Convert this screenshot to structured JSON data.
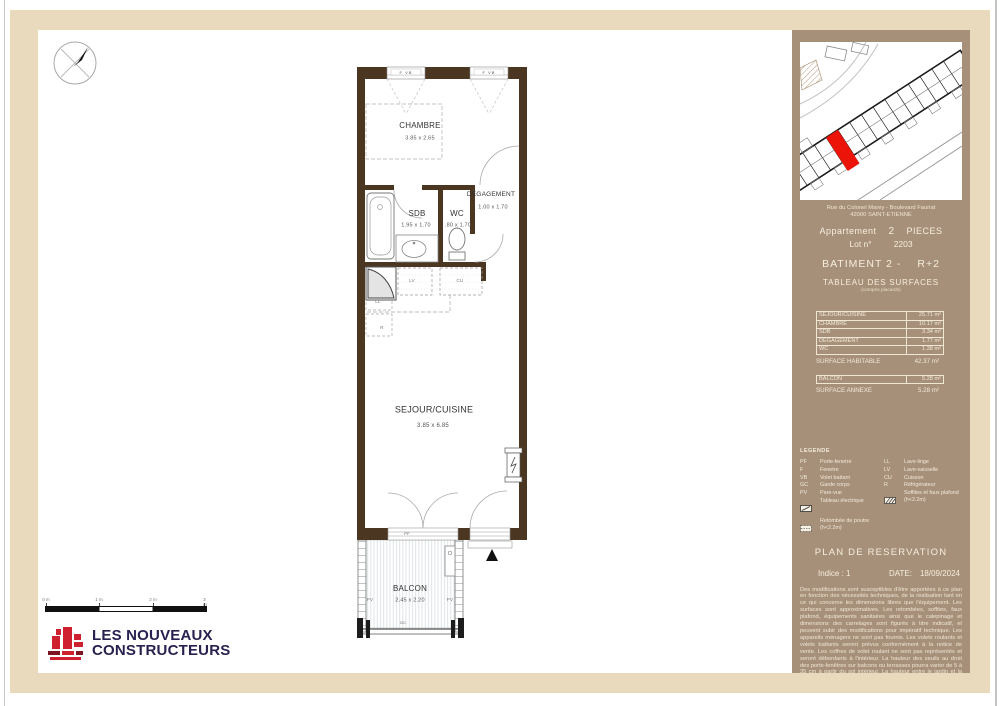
{
  "plan": {
    "rooms": {
      "chambre": {
        "name": "CHAMBRE",
        "dims": "3.85 x 2.65"
      },
      "degagement": {
        "name": "DEGAGEMENT",
        "dims": "1.00 x 1.70"
      },
      "sdb": {
        "name": "SDB",
        "dims": "1.95 x 1.70"
      },
      "wc": {
        "name": "WC",
        "dims": ".80 x 1.70"
      },
      "sejour": {
        "name": "SEJOUR/CUISINE",
        "dims": "3.85 x 6.85"
      },
      "balcon": {
        "name": "BALCON",
        "dims": "2.45 x 2.20"
      }
    },
    "tags": {
      "f_vb": "F  VB",
      "pf": "PF",
      "pv": "PV",
      "gc": "GC",
      "lv": "LV",
      "cu": "CU",
      "ll": "LL",
      "r": "R"
    },
    "colors": {
      "wall": "#4a3621",
      "highlight_unit": "#ec1309"
    }
  },
  "scale_bar": {
    "labels": [
      "0 m",
      "1 m",
      "2 m",
      "3 m"
    ]
  },
  "logo": {
    "line1": "LES NOUVEAUX",
    "line2": "CONSTRUCTEURS",
    "accent": "#cf2030",
    "text_color": "#2a2150"
  },
  "sidebar": {
    "address_line1": "Rue du Colonel Marey - Boulevard Fauriat",
    "address_line2": "42000 SAINT-ETIENNE",
    "apartment": {
      "label": "Appartement",
      "rooms_count": "2",
      "rooms_label": "PIECES"
    },
    "lot": {
      "label": "Lot n°",
      "number": "2203"
    },
    "building": "BATIMENT 2 -",
    "floor": "R+2",
    "surfaces_title": "TABLEAU DES SURFACES",
    "surfaces_subtitle": "(compris placards)",
    "table": {
      "rows": [
        {
          "label": "SEJOUR/CUISINE",
          "value": "25.71 m²"
        },
        {
          "label": "CHAMBRE",
          "value": "10.17 m²"
        },
        {
          "label": "SDB",
          "value": "3.34 m²"
        },
        {
          "label": "DEGAGEMENT",
          "value": "1.77 m²"
        },
        {
          "label": "WC",
          "value": "1.38 m²"
        }
      ],
      "habitable": {
        "label": "SURFACE HABITABLE",
        "value": "42.37 m²"
      },
      "balcon": {
        "label": "BALCON",
        "value": "5.28 m²"
      },
      "annexe": {
        "label": "SURFACE ANNEXE",
        "value": "5.28 m²"
      }
    },
    "legend": {
      "title": "LEGENDE",
      "left": [
        {
          "abbr": "PF",
          "label": "Porte-fenetre"
        },
        {
          "abbr": "F",
          "label": "Fenetre"
        },
        {
          "abbr": "VB",
          "label": "Volet battant"
        },
        {
          "abbr": "GC",
          "label": "Garde corps"
        },
        {
          "abbr": "PV",
          "label": "Pare-vue"
        },
        {
          "icon": "electrical-panel-icon",
          "label": "Tableau électrique"
        },
        {
          "icon": "beam-drop-icon",
          "label": "Retombée de poutre",
          "label2": "(h<2.2m)"
        }
      ],
      "right": [
        {
          "abbr": "LL",
          "label": "Lave-linge"
        },
        {
          "abbr": "LV",
          "label": "Lave-vaisselle"
        },
        {
          "abbr": "CU",
          "label": "Cuisson"
        },
        {
          "abbr": "R",
          "label": "Réfrigérateur"
        },
        {
          "icon": "soffit-hatch-icon",
          "label": "Soffites et faux plafond",
          "label2": "(h<2.2m)"
        }
      ]
    },
    "plan_type": "PLAN DE RESERVATION",
    "indice": "Indice : 1",
    "date_label": "DATE:",
    "date_value": "18/09/2024",
    "panel_color": "#a7907a",
    "disclaimer": "Des modifications sont susceptibles d'être apportées à ce plan en fonction des nécessités techniques, de la réalisation tant en ce qui concerne les dimensions libres que l'équipement. Les surfaces sont approximatives. Les retombées, soffites, faux plafond, équipements sanitaires ainsi que le calepinage et dimensions des carrelages sont figurés à titre indicatif, et peuvent subir des modifications pour impératif technique. Les appareils ménagers ne sont pas fournis. Les volets roulants et volets battants seront prévus conformément à la notice de vente. Les coffres de volet roulant ne sont pas représentés et seront débordants à l'intérieur. La hauteur des seuils au droit des porte-fenêtres sur balcons ou terrasses pourra varier de 5 à 35 cm à partir du sol intérieur. La hauteur entre le jardin et la terrasse pourra varier entre 0 et 60 cm. Les jardins ne seront pas nécessairement plats et pourront comporter des talus et des pentes."
  }
}
